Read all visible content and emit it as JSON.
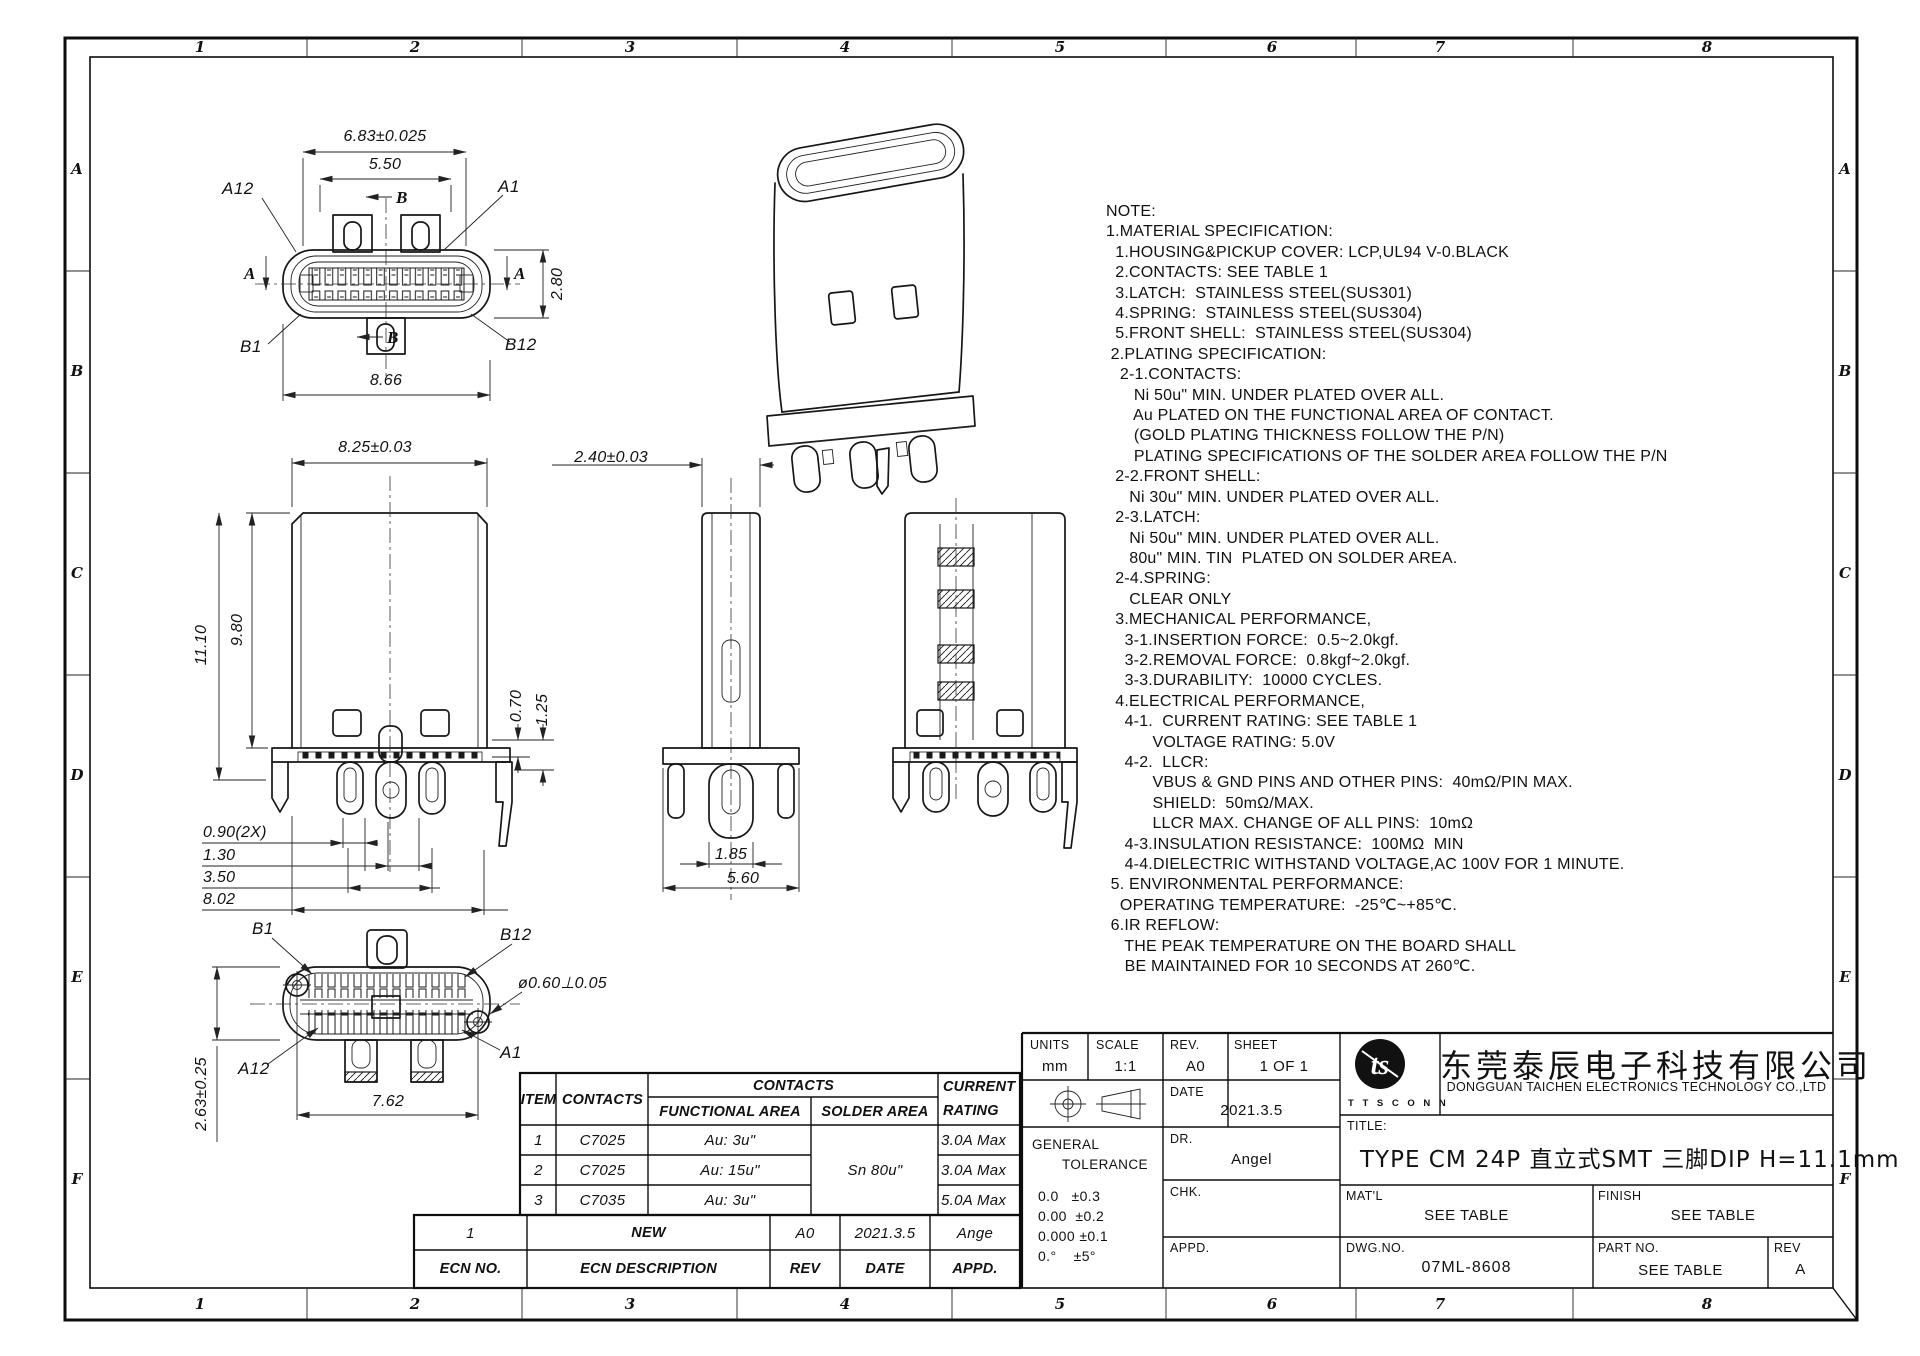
{
  "sheet": {
    "zone_cols": [
      "1",
      "2",
      "3",
      "4",
      "5",
      "6",
      "7",
      "8"
    ],
    "zone_rows": [
      "A",
      "B",
      "C",
      "D",
      "E",
      "F"
    ]
  },
  "views": {
    "top": {
      "dim_outer": "6.83±0.025",
      "dim_tongue": "5.50",
      "dim_height": "2.80",
      "dim_shell": "8.66",
      "pin_a12": "A12",
      "pin_a1": "A1",
      "pin_b1": "B1",
      "pin_b12": "B12",
      "section_a": "A",
      "section_b": "B"
    },
    "front": {
      "dim_width": "8.25±0.03",
      "dim_total_height": "11.10",
      "dim_body_height": "9.80",
      "dim_pin_offset1": "0.70",
      "dim_pin_offset2": "1.25",
      "dim_pitch1": "0.90(2X)",
      "dim_pitch2": "1.30",
      "dim_pitch3": "3.50",
      "dim_span": "8.02"
    },
    "side": {
      "dim_width": "2.40±0.03",
      "dim_tail": "1.85",
      "dim_depth": "5.60"
    },
    "bottom": {
      "pin_b1": "B1",
      "pin_b12": "B12",
      "pin_a12": "A12",
      "pin_a1": "A1",
      "dim_span": "7.62",
      "dim_height": "2.63±0.25",
      "dim_hole": "ø0.60⊥0.05"
    }
  },
  "notes": {
    "lines": [
      "NOTE:",
      "1.MATERIAL SPECIFICATION:",
      "  1.HOUSING&PICKUP COVER: LCP,UL94 V-0.BLACK",
      "  2.CONTACTS: SEE TABLE 1",
      "  3.LATCH:  STAINLESS STEEL(SUS301)",
      "  4.SPRING:  STAINLESS STEEL(SUS304)",
      "  5.FRONT SHELL:  STAINLESS STEEL(SUS304)",
      " 2.PLATING SPECIFICATION:",
      "   2-1.CONTACTS:",
      "      Ni 50u\" MIN. UNDER PLATED OVER ALL.",
      "      Au PLATED ON THE FUNCTIONAL AREA OF CONTACT.",
      "      (GOLD PLATING THICKNESS FOLLOW THE P/N)",
      "      PLATING SPECIFICATIONS OF THE SOLDER AREA FOLLOW THE P/N",
      "  2-2.FRONT SHELL:",
      "     Ni 30u\" MIN. UNDER PLATED OVER ALL.",
      "  2-3.LATCH:",
      "     Ni 50u\" MIN. UNDER PLATED OVER ALL.",
      "     80u\" MIN. TIN  PLATED ON SOLDER AREA.",
      "  2-4.SPRING:",
      "     CLEAR ONLY",
      "  3.MECHANICAL PERFORMANCE,",
      "    3-1.INSERTION FORCE:  0.5~2.0kgf.",
      "    3-2.REMOVAL FORCE:  0.8kgf~2.0kgf.",
      "    3-3.DURABILITY:  10000 CYCLES.",
      "  4.ELECTRICAL PERFORMANCE,",
      "    4-1.  CURRENT RATING: SEE TABLE 1",
      "          VOLTAGE RATING: 5.0V",
      "    4-2.  LLCR:",
      "          VBUS & GND PINS AND OTHER PINS:  40mΩ/PIN MAX.",
      "          SHIELD:  50mΩ/MAX.",
      "          LLCR MAX. CHANGE OF ALL PINS:  10mΩ",
      "    4-3.INSULATION RESISTANCE:  100MΩ  MIN",
      "    4-4.DIELECTRIC WITHSTAND VOLTAGE,AC 100V FOR 1 MINUTE.",
      " 5. ENVIRONMENTAL PERFORMANCE:",
      "   OPERATING TEMPERATURE:  -25℃~+85℃.",
      " 6.IR REFLOW:",
      "    THE PEAK TEMPERATURE ON THE BOARD SHALL",
      "    BE MAINTAINED FOR 10 SECONDS AT 260℃."
    ]
  },
  "contacts_table": {
    "col_item": "ITEM",
    "col_contacts": "CONTACTS",
    "group_contacts": "CONTACTS",
    "col_functional": "FUNCTIONAL AREA",
    "col_solder": "SOLDER AREA",
    "col_current_1": "CURRENT",
    "col_current_2": "RATING",
    "solder_value": "Sn 80u\"",
    "rows": [
      {
        "item": "1",
        "contacts": "C7025",
        "functional": "Au: 3u\"",
        "current": "3.0A Max"
      },
      {
        "item": "2",
        "contacts": "C7025",
        "functional": "Au: 15u\"",
        "current": "3.0A Max"
      },
      {
        "item": "3",
        "contacts": "C7035",
        "functional": "Au: 3u\"",
        "current": "5.0A Max"
      }
    ]
  },
  "ecn_table": {
    "row": {
      "no": "1",
      "desc": "NEW",
      "rev": "A0",
      "date": "2021.3.5",
      "appd": "Ange"
    },
    "headers": {
      "no": "ECN NO.",
      "desc": "ECN  DESCRIPTION",
      "rev": "REV",
      "date": "DATE",
      "appd": "APPD."
    }
  },
  "title_block": {
    "units_label": "UNITS",
    "units_value": "mm",
    "scale_label": "SCALE",
    "scale_value": "1:1",
    "rev_label": "REV.",
    "rev_value": "A0",
    "sheet_label": "SHEET",
    "sheet_value": "1 OF 1",
    "date_label": "DATE",
    "date_value": "2021.3.5",
    "dr_label": "DR.",
    "dr_value": "Angel",
    "chk_label": "CHK.",
    "chk_value": "",
    "appd_label": "APPD.",
    "appd_value": "",
    "general_tolerance_1": "GENERAL",
    "general_tolerance_2": "TOLERANCE",
    "tolerances": [
      "0.0   ±0.3",
      "0.00  ±0.2",
      "0.000 ±0.1",
      "0.°    ±5°"
    ],
    "logo_text": "ts",
    "logo_sub": "T T S C O N N",
    "company_cn": "东莞泰辰电子科技有限公司",
    "company_en": "DONGGUAN  TAICHEN  ELECTRONICS  TECHNOLOGY  CO.,LTD",
    "title_label": "TITLE:",
    "title_value": "TYPE  CM  24P  直立式SMT  三脚DIP  H=11.1mm",
    "matl_label": "MAT'L",
    "matl_value": "SEE TABLE",
    "finish_label": "FINISH",
    "finish_value": "SEE TABLE",
    "dwgno_label": "DWG.NO.",
    "dwgno_value": "07ML-8608",
    "partno_label": "PART NO.",
    "partno_value": "SEE TABLE",
    "rev2_label": "REV",
    "rev2_value": "A"
  }
}
